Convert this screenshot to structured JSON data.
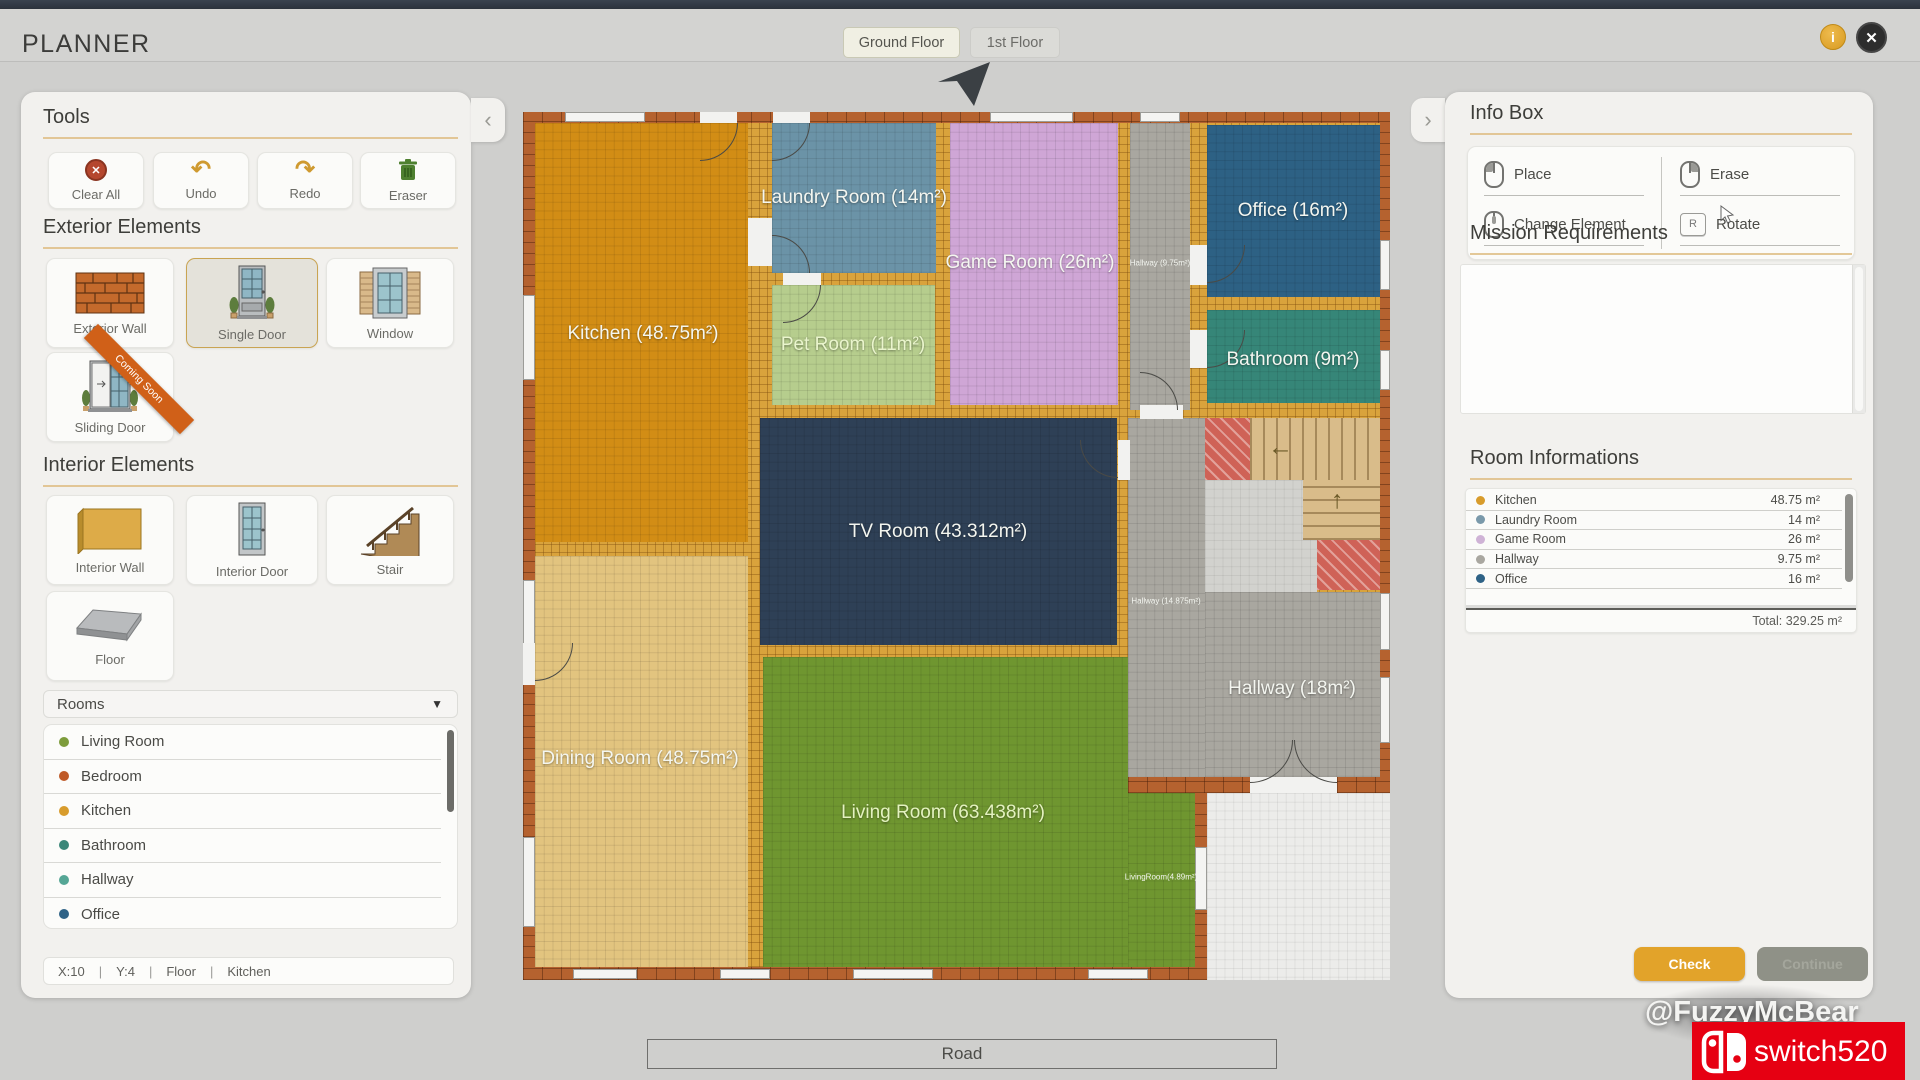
{
  "colors": {
    "accent_orange": "#e2a32a",
    "brick_wall": "#b5622f",
    "interior_wall": "#d9a33c"
  },
  "icons": {
    "info": "i",
    "close": "✕",
    "caret_down": "▼",
    "chevron_left": "‹",
    "chevron_right": "›",
    "undo": "↶",
    "redo": "↷",
    "clear_x": "✕",
    "arrow_left": "←",
    "arrow_up": "↑"
  },
  "top_bar": {
    "title": "PLANNER",
    "tabs": [
      {
        "label": "Ground Floor",
        "active": true
      },
      {
        "label": "1st Floor",
        "active": false
      }
    ]
  },
  "left_panel": {
    "tools": {
      "heading": "Tools",
      "items": [
        {
          "label": "Clear All",
          "icon": "clear-all-icon"
        },
        {
          "label": "Undo",
          "icon": "undo-icon"
        },
        {
          "label": "Redo",
          "icon": "redo-icon"
        },
        {
          "label": "Eraser",
          "icon": "trash-icon"
        }
      ]
    },
    "exterior": {
      "heading": "Exterior Elements",
      "items": [
        {
          "label": "Exterior Wall"
        },
        {
          "label": "Single Door",
          "selected": true
        },
        {
          "label": "Window"
        },
        {
          "label": "Sliding Door",
          "ribbon": "Coming Soon"
        }
      ]
    },
    "interior": {
      "heading": "Interior Elements",
      "items": [
        {
          "label": "Interior Wall"
        },
        {
          "label": "Interior Door"
        },
        {
          "label": "Stair"
        },
        {
          "label": "Floor"
        }
      ]
    },
    "rooms_dropdown": {
      "label": "Rooms",
      "options": [
        {
          "label": "Living Room",
          "color": "#7d9c3b"
        },
        {
          "label": "Bedroom",
          "color": "#bf5a28"
        },
        {
          "label": "Kitchen",
          "color": "#d89c2c"
        },
        {
          "label": "Bathroom",
          "color": "#3a8678"
        },
        {
          "label": "Hallway",
          "color": "#55a695"
        },
        {
          "label": "Office",
          "color": "#2e6286"
        }
      ]
    },
    "status_bar": {
      "x": "X:10",
      "y": "Y:4",
      "layer": "Floor",
      "room": "Kitchen",
      "sep": "|"
    }
  },
  "canvas": {
    "plan_rooms": [
      {
        "name": "Kitchen",
        "label": "Kitchen (48.75m²)",
        "color": "#d28d15"
      },
      {
        "name": "Laundry Room",
        "label": "Laundry Room (14m²)",
        "color": "#6b93a7"
      },
      {
        "name": "Game Room",
        "label": "Game Room (26m²)",
        "color": "#cfa6d6"
      },
      {
        "name": "Pet Room",
        "label": "Pet Room (11m²)",
        "color": "#b6cd8d"
      },
      {
        "name": "Office",
        "label": "Office (16m²)",
        "color": "#2d6184"
      },
      {
        "name": "Bathroom",
        "label": "Bathroom (9m²)",
        "color": "#368678"
      },
      {
        "name": "TV Room",
        "label": "TV Room (43.312m²)",
        "color": "#2e4056"
      },
      {
        "name": "Dining Room",
        "label": "Dining Room (48.75m²)",
        "color": "#e2c47f"
      },
      {
        "name": "Living Room",
        "label": "Living Room (63.438m²)",
        "color": "#6f9630"
      },
      {
        "name": "Hallway",
        "label": "Hallway (18m²)",
        "color": "#a9a7a0"
      },
      {
        "name": "Hallway small",
        "label": "Hallway (9.75m²)",
        "color": "#a9a7a0"
      },
      {
        "name": "Hallway mid",
        "label": "Hallway (14.875m²)",
        "color": "#a9a7a0"
      },
      {
        "name": "Living Room annex",
        "label": "LivingRoom(4.89m²)",
        "color": "#6f9630"
      }
    ],
    "road_label": "Road"
  },
  "right_panel": {
    "info_box": {
      "heading": "Info Box",
      "entries": [
        {
          "label": "Place",
          "icon": "mouse-left-icon"
        },
        {
          "label": "Change Element",
          "icon": "mouse-wheel-icon"
        },
        {
          "label": "Erase",
          "icon": "mouse-right-icon"
        },
        {
          "label": "Rotate",
          "icon": "key-r-icon",
          "key": "R"
        }
      ]
    },
    "mission": {
      "heading": "Mission Requirements"
    },
    "room_info": {
      "heading": "Room Informations",
      "rows": [
        {
          "name": "Kitchen",
          "area": "48.75 m²",
          "color": "#d89c2c"
        },
        {
          "name": "Laundry Room",
          "area": "14 m²",
          "color": "#7a99aa"
        },
        {
          "name": "Game Room",
          "area": "26 m²",
          "color": "#cfb3d6"
        },
        {
          "name": "Hallway",
          "area": "9.75 m²",
          "color": "#a9a7a0"
        },
        {
          "name": "Office",
          "area": "16 m²",
          "color": "#2e6286"
        }
      ],
      "total": "Total: 329.25 m²"
    },
    "buttons": {
      "check": "Check",
      "continue": "Continue"
    }
  },
  "watermark": {
    "handle": "@FuzzyMcBear",
    "badge": "switch520"
  }
}
